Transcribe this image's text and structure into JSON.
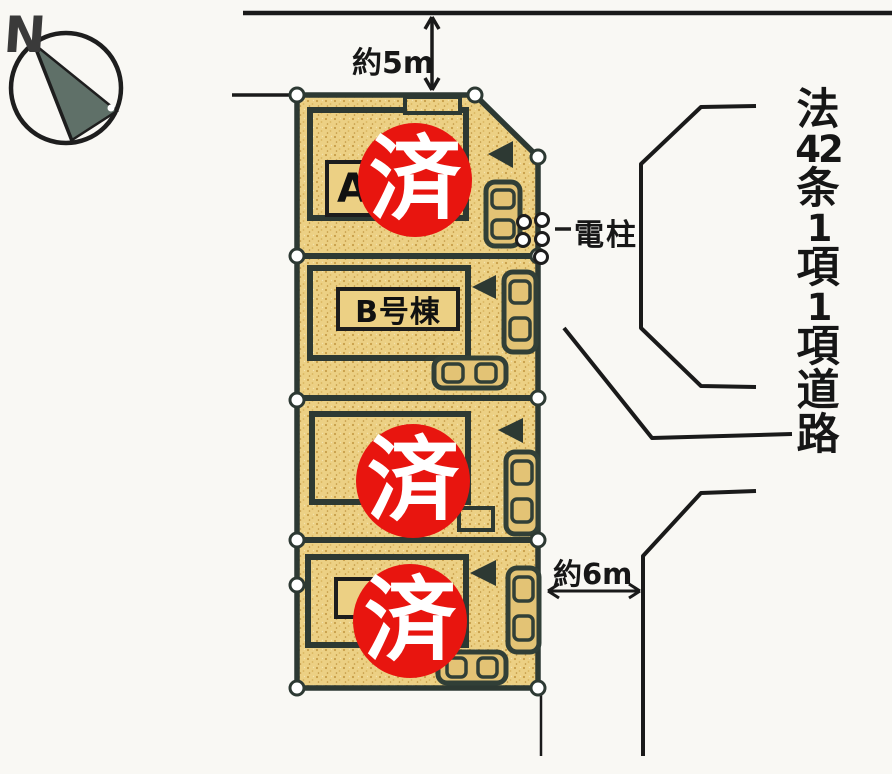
{
  "compass": {
    "label": "N"
  },
  "dimensions": {
    "top_road": "約5m",
    "side_road": "約6m"
  },
  "annotations": {
    "utility_pole": "電柱",
    "road_designation": "法42条1項1項道路",
    "road_chars": [
      "法",
      "42",
      "条",
      "1",
      "項",
      "1",
      "項",
      "道",
      "路"
    ]
  },
  "lots": [
    {
      "name": "lot-1",
      "label": "A",
      "stamp": "済"
    },
    {
      "name": "lot-2",
      "label": "B号棟",
      "stamp": ""
    },
    {
      "name": "lot-3",
      "label": "",
      "stamp": "済"
    },
    {
      "name": "lot-4",
      "label": "",
      "stamp": "済"
    }
  ],
  "colors": {
    "background": "#f9f8f4",
    "lot_fill": "#ecd084",
    "plan_line": "#2d3933",
    "road_line": "#1a1a1a",
    "stamp_red": "#e8150f",
    "stamp_text": "#ffffff",
    "compass_needle": "#5f7068"
  }
}
